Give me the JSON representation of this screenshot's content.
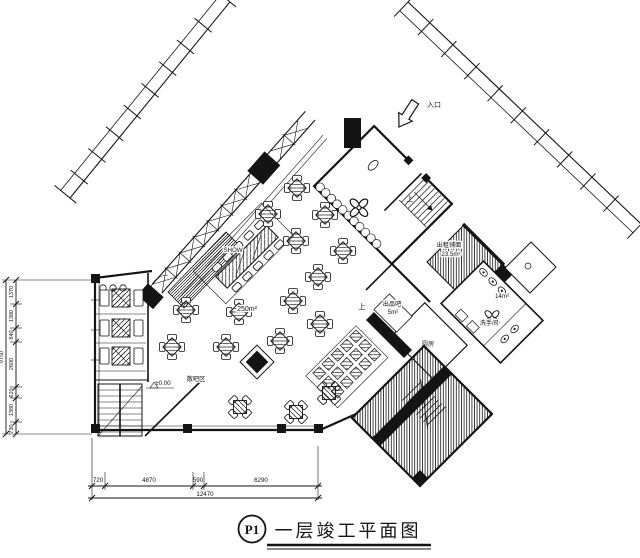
{
  "title_block": {
    "tag": "P1",
    "title": "一层竣工平面图"
  },
  "labels": {
    "entrance": "入口",
    "stage": "SHOW",
    "hall_area": "250m²",
    "lounge_zone": "散吧区",
    "service_bar": "出品吧",
    "service_bar_area": "5m²",
    "kitchen": "厨房",
    "restroom": "洗手间",
    "restroom_area": "14m²",
    "rental_shop": "出租铺面",
    "rental_shop_area": "23.5m²",
    "level_mark": "±0.00",
    "stair_up_lobby": "上",
    "stair_up_bar": "上"
  },
  "dimensions": {
    "bottom_segments": [
      "720",
      "4870",
      "590",
      "6290"
    ],
    "bottom_total": "12470",
    "left_segments": [
      "1370",
      "1380",
      "840",
      "2600",
      "610",
      "1380",
      "730"
    ],
    "left_total": "9750"
  },
  "colors": {
    "ink": "#141414",
    "paper": "#ffffff"
  }
}
